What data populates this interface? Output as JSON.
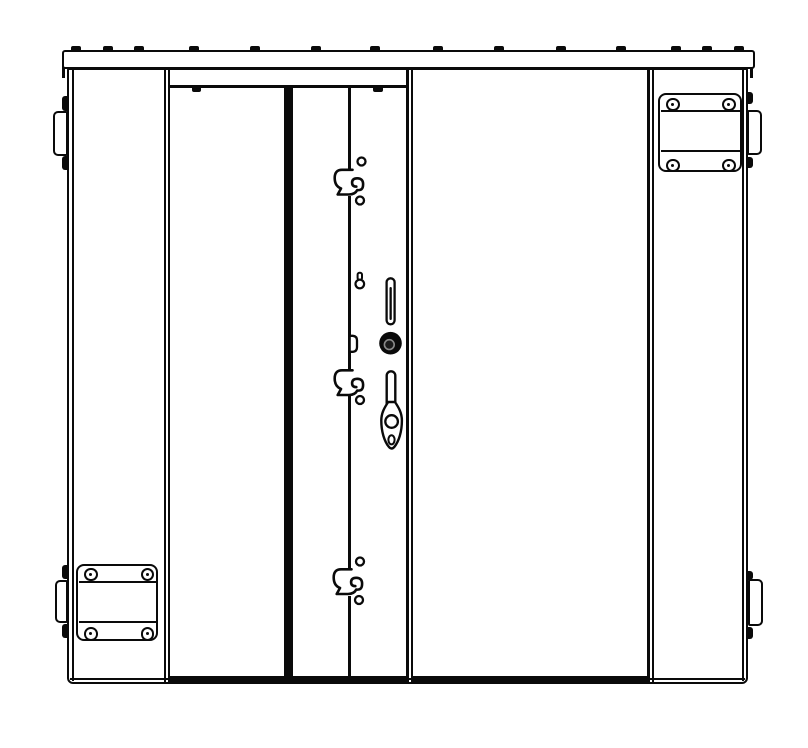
{
  "drawing": {
    "kind": "technical-line-drawing",
    "subject": "double-door equipment enclosure, front elevation",
    "colors": {
      "line": "#0a0a0a",
      "background": "#ffffff"
    },
    "components": {
      "top_rail": "top rail with weld tabs",
      "left_side_panel": "left side panel",
      "left_door": "left door leaf",
      "center_latch_strip": "center latch channel strip",
      "right_door": "right door leaf",
      "right_side_panel": "right side panel",
      "lock_cylinder": "round key lock cylinder",
      "swing_handle": "drop swing handle with finger hole",
      "latch_hooks": "three latch hook cutouts with rivet holes",
      "keyhole_cutout": "small keyhole cutout",
      "vertical_slot": "vertical slotted cutout",
      "corner_plates": "bolted reinforcement plates (top-right, bottom-left)",
      "side_tabs": "four side mounting tabs with weld nubs"
    }
  }
}
